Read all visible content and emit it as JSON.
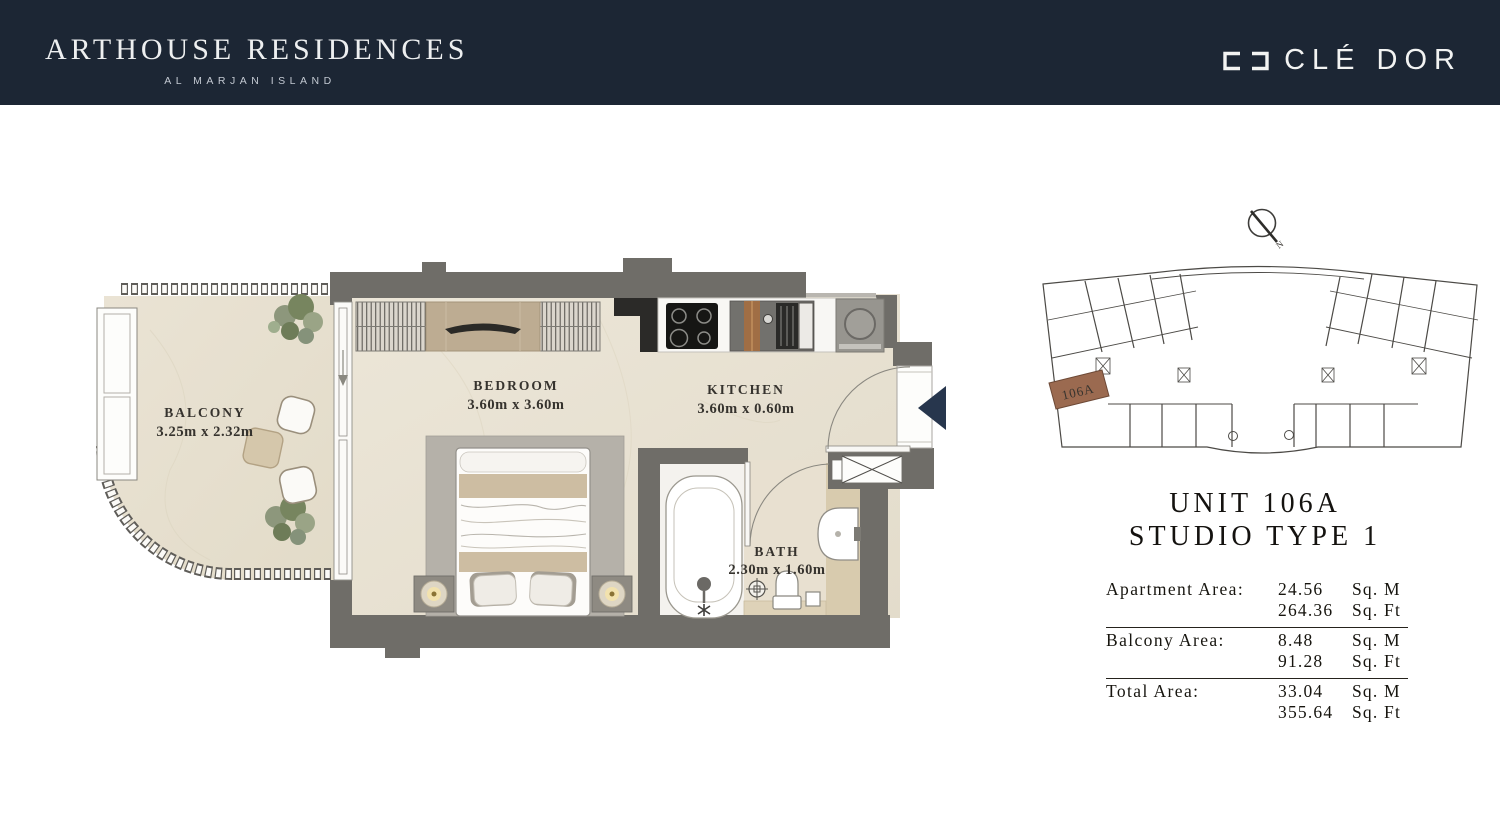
{
  "header": {
    "brand_title": "ARTHOUSE RESIDENCES",
    "brand_subtitle": "AL MARJAN ISLAND",
    "logo_text": "CLÉ DOR"
  },
  "floor_plan": {
    "rooms": [
      {
        "name": "BALCONY",
        "dimensions": "3.25m x 2.32m"
      },
      {
        "name": "BEDROOM",
        "dimensions": "3.60m x 3.60m"
      },
      {
        "name": "KITCHEN",
        "dimensions": "3.60m x 0.60m"
      },
      {
        "name": "BATH",
        "dimensions": "2.30m x 1.60m"
      }
    ]
  },
  "key_plan": {
    "unit_label": "106A",
    "compass_label": "N"
  },
  "unit_info": {
    "title_line1": "UNIT 106A",
    "title_line2": "STUDIO TYPE 1"
  },
  "area_table": {
    "rows": [
      {
        "label": "Apartment Area:",
        "sqm": "24.56",
        "sqm_unit": "Sq. M",
        "sqft": "264.36",
        "sqft_unit": "Sq. Ft"
      },
      {
        "label": "Balcony Area:",
        "sqm": "8.48",
        "sqm_unit": "Sq. M",
        "sqft": "91.28",
        "sqft_unit": "Sq. Ft"
      },
      {
        "label": "Total Area:",
        "sqm": "33.04",
        "sqm_unit": "Sq. M",
        "sqft": "355.64",
        "sqft_unit": "Sq. Ft"
      }
    ]
  },
  "colors": {
    "header_navy": "#1c2634",
    "wall_gray": "#6f6d68",
    "floor_cream": "#ebe5d7",
    "bath_tan": "#d8cbae",
    "unit_highlight_brown": "#9b6a50",
    "entry_arrow_navy": "#27364d"
  }
}
